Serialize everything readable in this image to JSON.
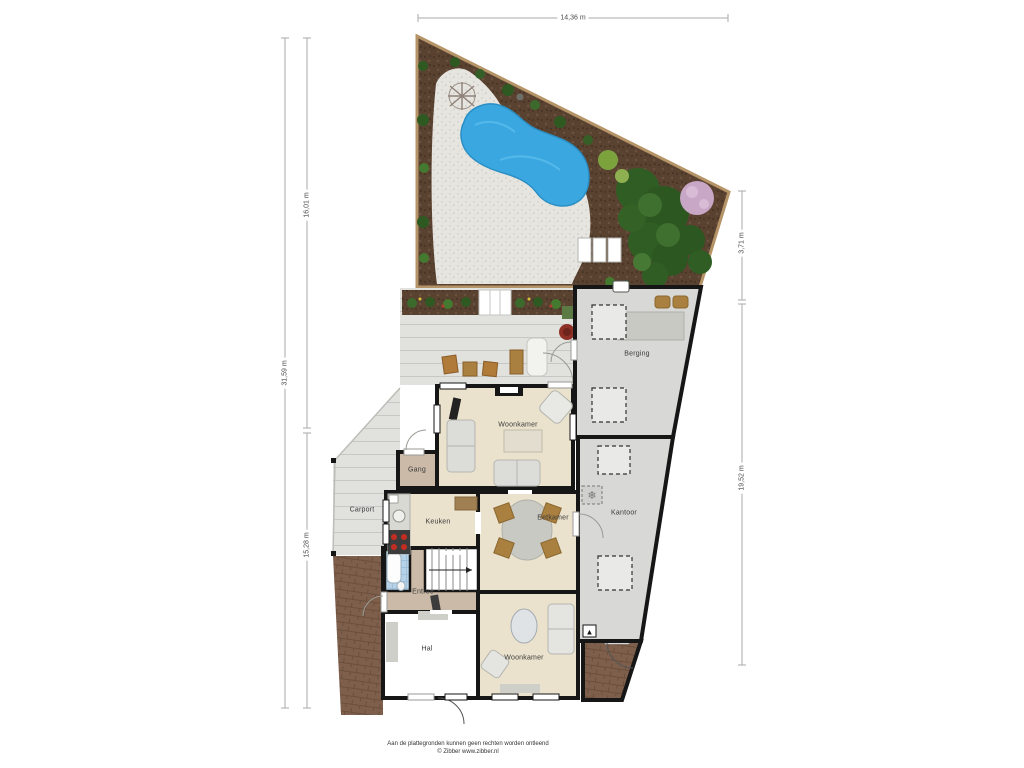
{
  "dimensions": {
    "top": "14,36 m",
    "left_outer": "31,59 m",
    "left_inner_upper": "16,01 m",
    "left_inner_lower": "15,28 m",
    "right_upper": "3,71 m",
    "right_lower": "19,52 m"
  },
  "rooms": {
    "woonkamer_upper": "Woonkamer",
    "gang": "Gang",
    "carport": "Carport",
    "keuken": "Keuken",
    "eetkamer": "Eetkamer",
    "kantoor": "Kantoor",
    "berging": "Berging",
    "entree": "Entree",
    "hal": "Hal",
    "woonkamer_lower": "Woonkamer"
  },
  "icons": {
    "ventilation": "❄",
    "entrance_marker": "▲"
  },
  "footer": {
    "disclaimer": "Aan de plattegronden kunnen geen rechten worden ontleend",
    "copyright": "© Zibber www.zibber.nl"
  },
  "colors": {
    "pool_blue": "#3aa7e0",
    "soil_brown": "#5a4231",
    "gravel": "#e7e5e0",
    "deck_gray": "#e1e1de",
    "floor_beige": "#eae2cd",
    "floor_tan": "#cbbaa7",
    "floor_gray": "#d8d8d6",
    "paving_brick": "#7d5f4b",
    "wall_black": "#161616",
    "fence_tan": "#b59468"
  }
}
